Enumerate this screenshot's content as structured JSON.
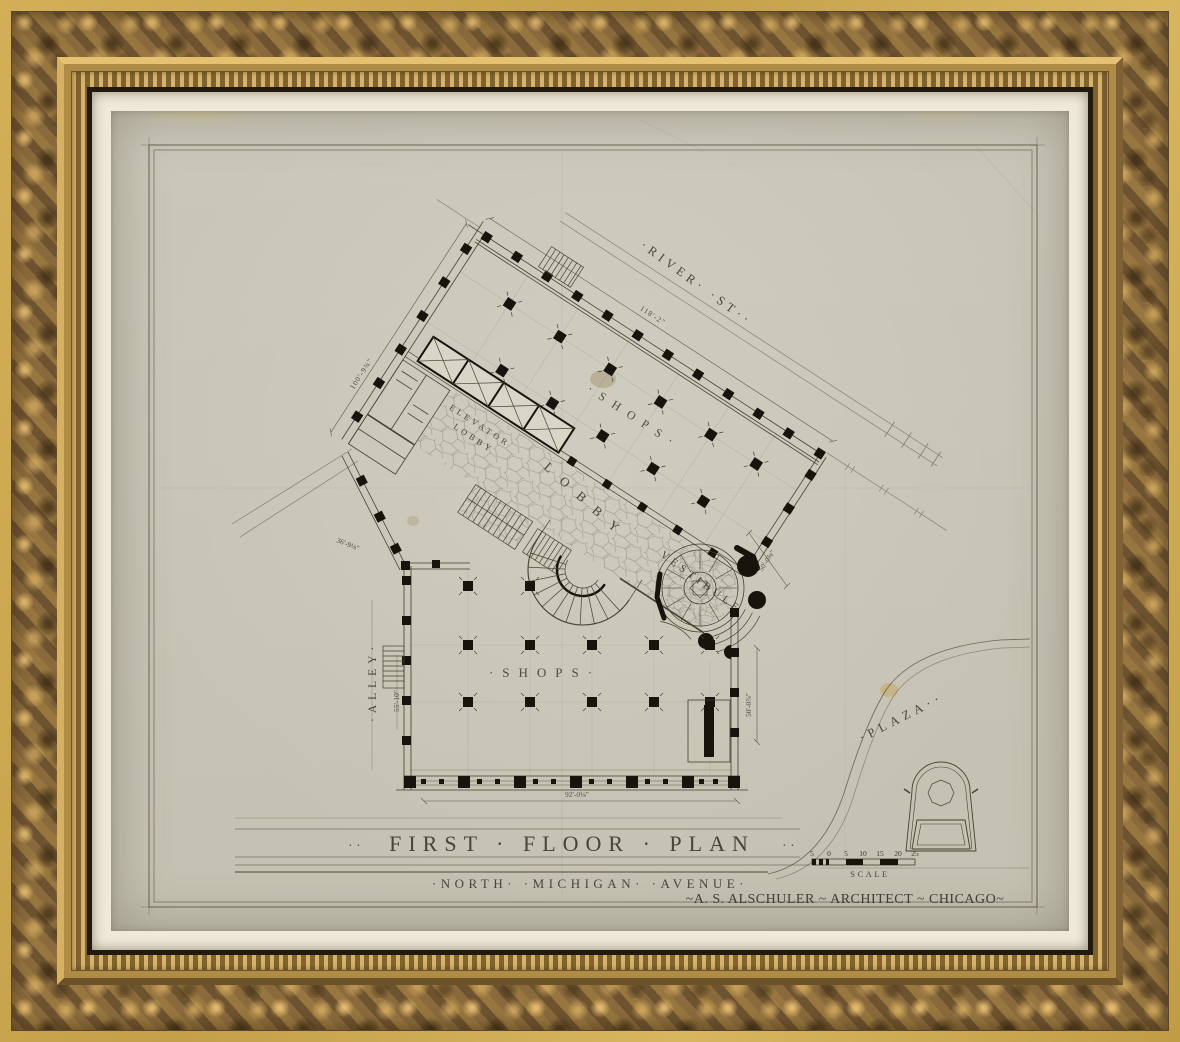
{
  "artwork": {
    "title_block": {
      "ornament_left": "· ·",
      "title": "FIRST · FLOOR · PLAN",
      "ornament_right": "· ·",
      "street_label": "·NORTH·  ·MICHIGAN·  ·AVENUE·",
      "credit": "~A. S. ALSCHULER ~ ARCHITECT ~ CHICAGO~"
    },
    "streets": {
      "river": "·RIVER·  ·ST··",
      "alley": "·ALLEY·",
      "plaza": "·PLAZA··"
    },
    "rooms": {
      "shops_upper": "·SHOPS·",
      "shops_lower": "·SHOPS·",
      "lobby": "LOBBY",
      "elevator_lobby_line1": "ELEVATOR",
      "elevator_lobby_line2": "LOBBY",
      "vestibule": "VESTIBULE"
    },
    "dimensions": {
      "river_frontage": "118'-2\"",
      "alley_frontage_upper": "100'-9¾\"",
      "diagonal_wall": "36'-9⅛\"",
      "alley_frontage_lower": "55'-10\"",
      "vestibule_side": "50'-0⅝\"",
      "east_side": "50'-0⅞\"",
      "avenue_frontage": "92'-0⅛\""
    },
    "scale_bar": {
      "label": "SCALE",
      "ticks": [
        "5",
        "0",
        "5",
        "10",
        "15",
        "20",
        "25"
      ]
    }
  }
}
